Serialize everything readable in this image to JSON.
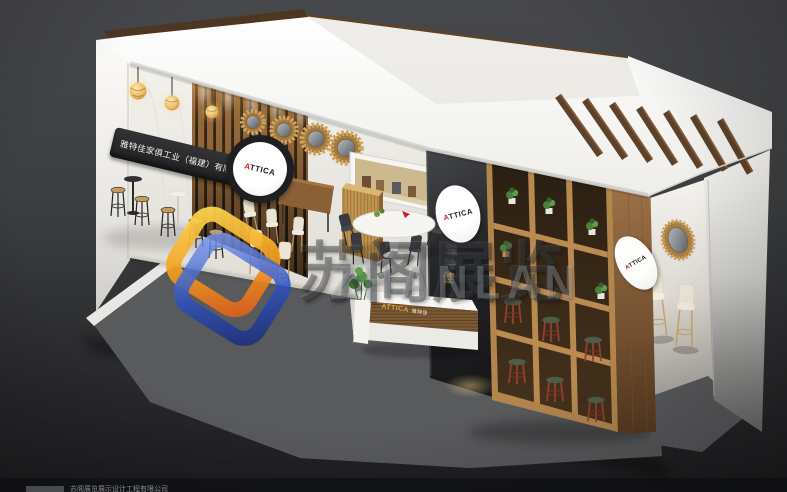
{
  "scene": {
    "description": "3D render of an ATTICA furniture exhibition booth on dark floor",
    "background_color": "#3a3c3e",
    "carpet_color": "#95979b",
    "wood_color": "#8a6234",
    "charcoal_panel_color": "#232426",
    "fascia_color": "#f4f3f0"
  },
  "brand": {
    "initial": "A",
    "rest": "TTICA",
    "name_en": "ATTICA",
    "name_cn_chars": [
      "雅",
      "特",
      "佳"
    ],
    "company_full": "雅特佳家俱工业（福建）有限公司",
    "accent_red": "#cf2128",
    "accent_gold": "#c9a24b"
  },
  "desk": {
    "sub_label": "雅特佳"
  },
  "watermark": {
    "cn": "苏阁展览",
    "latin": "ZHANLAN",
    "logo_orange": "#f29c1d",
    "logo_blue": "#2d50c2"
  },
  "footer": {
    "caption": "苏阁展览展示设计工程有限公司"
  }
}
